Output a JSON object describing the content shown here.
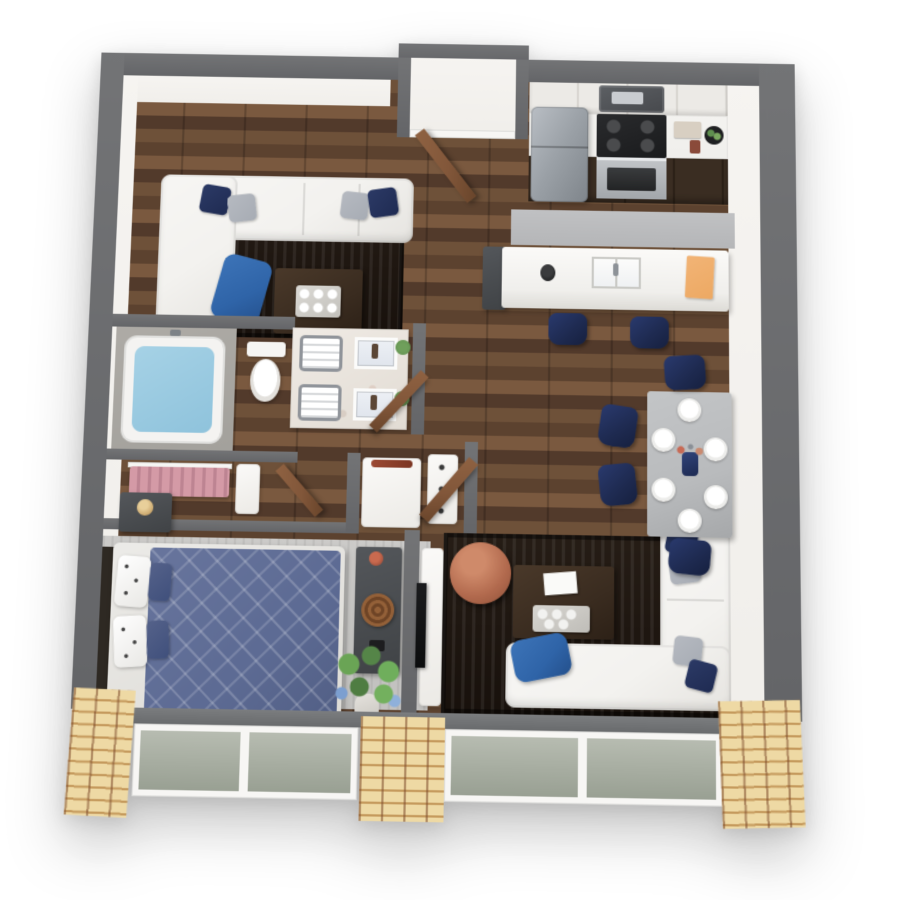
{
  "image": {
    "kind": "3d-rendered-floor-plan",
    "view": "top-down isometric cutaway",
    "subject": "one-bedroom apartment",
    "visible_text": "none"
  },
  "palette": {
    "wall_gray": "#646568",
    "wall_face": "#f1efeb",
    "floor_wood": "#6e5139",
    "floor_wood_dark": "#5c422f",
    "rug_dark": "#18110c",
    "rug_light": "#c2c1bf",
    "rug_kitchen": "#b5b6b8",
    "sofa_white": "#f3f2ef",
    "pillow_navy": "#1f2b52",
    "pillow_gray": "#a7acb4",
    "throw_blue": "#2f64a8",
    "bed_blue": "#5d6b94",
    "table_gray": "#b9bbbd",
    "chair_navy": "#1e2a50",
    "wood_dark_furniture": "#3a2c20",
    "counter_white": "#f0efec",
    "cabinet_dark": "#3a2d22",
    "cabinet_light": "#eceae6",
    "steel": "#9aa0a6",
    "door_brown": "#82573a",
    "brick": "#eed9a4",
    "brick_mortar": "#c59a5d",
    "water_blue": "#8fc3dc",
    "accent_copper": "#b26a4e",
    "board_orange": "#eda963",
    "plant_green": "#5f8f4f",
    "clothes_pink": "#d49aa6",
    "tile_gray": "#a3a19c"
  },
  "rooms": [
    {
      "name": "living-room-upper",
      "items": [
        "white-l-sectional-sofa",
        "navy-pillows",
        "gray-pillows",
        "blue-throw-blanket",
        "dark-area-rug",
        "dark-wood-coffee-table",
        "serving-tray-with-cups"
      ]
    },
    {
      "name": "entry",
      "items": [
        "entry-door-brown-open",
        "entry-alcove"
      ]
    },
    {
      "name": "kitchen",
      "items": [
        "stainless-refrigerator",
        "microwave",
        "electric-range-with-oven",
        "white-upper-cabinets",
        "dark-lower-cabinets",
        "white-counter",
        "fruit-bowl",
        "coffee-maker",
        "cutting-board",
        "kitchen-runner-rug",
        "white-island-with-sink",
        "orange-cutting-board",
        "black-vase",
        "two-navy-bar-stools",
        "island-end-cabinet"
      ]
    },
    {
      "name": "dining-area",
      "items": [
        "gray-dining-table",
        "six-place-settings",
        "navy-dining-chairs-x4",
        "centerpiece-vase-with-branches"
      ]
    },
    {
      "name": "bathroom",
      "items": [
        "soaking-tub-with-water",
        "gray-tile-surround",
        "toilet",
        "marble-double-vanity",
        "two-sinks",
        "towel-stacks",
        "small-plants",
        "bathroom-door-brown"
      ]
    },
    {
      "name": "walk-in-closet",
      "items": [
        "pink-hanging-clothes",
        "closet-rod",
        "white-shelf-unit",
        "closet-door-brown"
      ]
    },
    {
      "name": "hall-laundry",
      "items": [
        "stacked-washer-dryer",
        "white-linen-shelf",
        "open-brown-doors",
        "white-door-frames"
      ]
    },
    {
      "name": "bedroom",
      "items": [
        "queen-bed-navy-diamond-quilt",
        "white-polka-dot-pillows",
        "dark-headboard",
        "nightstand-with-jar-lamp",
        "light-gray-area-rug",
        "dark-gray-dresser",
        "woven-basket",
        "flower-vase",
        "corner-plant-with-flowers"
      ]
    },
    {
      "name": "living-room-lower",
      "items": [
        "white-l-sectional-sofa",
        "navy-pillows",
        "gray-pillows",
        "blue-throw-blanket",
        "dark-area-rug",
        "dark-wood-coffee-table",
        "white-book",
        "tray-with-cups",
        "copper-leather-pouf",
        "tv-on-white-console"
      ]
    },
    {
      "name": "exterior",
      "items": [
        "dark-gray-cutaway-walls",
        "white-inner-wall-faces",
        "tan-brick-piers",
        "floor-to-ceiling-windows",
        "window-sill-ledge"
      ]
    }
  ]
}
